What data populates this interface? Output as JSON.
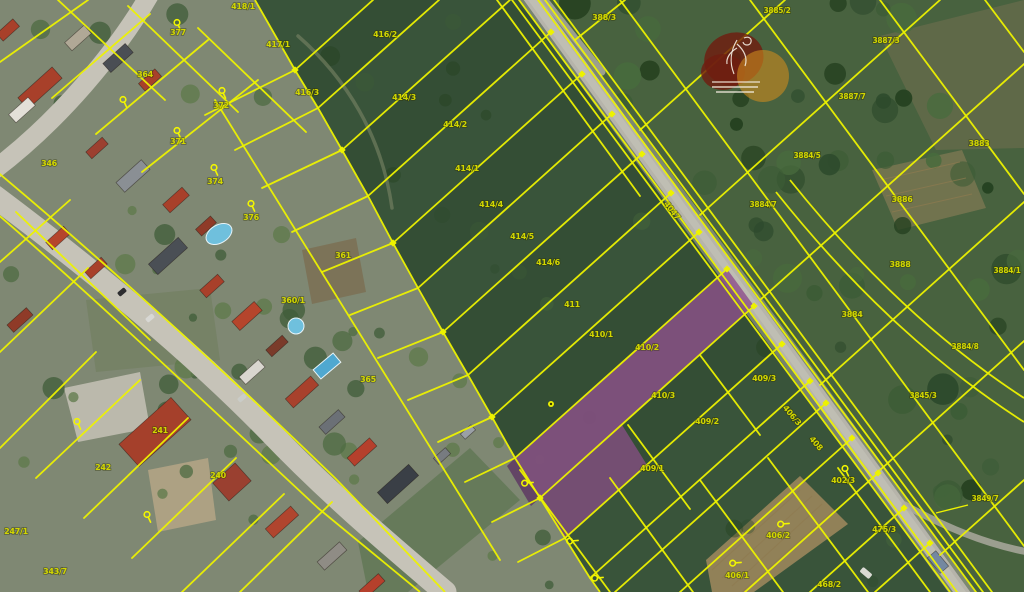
{
  "map": {
    "canvas": {
      "width": 1024,
      "height": 592
    },
    "colors": {
      "line_yellow": "#edf200",
      "label_yellow": "#d2d600",
      "selected_purple": "#8d4f8b",
      "selected_purple_dark": "#5e3a63",
      "field_green": "#39543a",
      "scrub_green": "#48623f",
      "village_base": "#7f8873",
      "road_gray": "#b6b4aa",
      "street_gray": "#c6c3b8",
      "watermark_maroon": "#6f1d10",
      "watermark_orange": "#cd8a1e"
    },
    "parcel_labels": [
      {
        "text": "418/1",
        "x": 243,
        "y": 9
      },
      {
        "text": "417/1",
        "x": 278,
        "y": 47
      },
      {
        "text": "416/2",
        "x": 385,
        "y": 37
      },
      {
        "text": "416/3",
        "x": 307,
        "y": 95
      },
      {
        "text": "414/3",
        "x": 404,
        "y": 100
      },
      {
        "text": "414/2",
        "x": 455,
        "y": 127
      },
      {
        "text": "414/1",
        "x": 467,
        "y": 171
      },
      {
        "text": "414/4",
        "x": 491,
        "y": 207
      },
      {
        "text": "414/5",
        "x": 522,
        "y": 239
      },
      {
        "text": "414/6",
        "x": 548,
        "y": 265
      },
      {
        "text": "411",
        "x": 572,
        "y": 307
      },
      {
        "text": "410/1",
        "x": 601,
        "y": 337
      },
      {
        "text": "410/2",
        "x": 647,
        "y": 350
      },
      {
        "text": "410/3",
        "x": 663,
        "y": 398
      },
      {
        "text": "409/3",
        "x": 764,
        "y": 381
      },
      {
        "text": "409/2",
        "x": 707,
        "y": 424
      },
      {
        "text": "409/1",
        "x": 652,
        "y": 471
      },
      {
        "text": "406/3",
        "x": 790,
        "y": 417,
        "rot": 50
      },
      {
        "text": "408",
        "x": 814,
        "y": 445,
        "rot": 50
      },
      {
        "text": "4047",
        "x": 670,
        "y": 212,
        "rot": 52
      },
      {
        "text": "388/3",
        "x": 604,
        "y": 20
      },
      {
        "text": "3885/2",
        "x": 777,
        "y": 13
      },
      {
        "text": "3887/3",
        "x": 886,
        "y": 43
      },
      {
        "text": "3887/7",
        "x": 852,
        "y": 99
      },
      {
        "text": "3883",
        "x": 979,
        "y": 146
      },
      {
        "text": "3884/5",
        "x": 807,
        "y": 158
      },
      {
        "text": "3884/7",
        "x": 763,
        "y": 207
      },
      {
        "text": "3886",
        "x": 902,
        "y": 202
      },
      {
        "text": "3888",
        "x": 900,
        "y": 267
      },
      {
        "text": "3884/1",
        "x": 1007,
        "y": 273
      },
      {
        "text": "3884",
        "x": 852,
        "y": 317
      },
      {
        "text": "3884/8",
        "x": 965,
        "y": 349
      },
      {
        "text": "3845/3",
        "x": 923,
        "y": 398
      },
      {
        "text": "3849/7",
        "x": 985,
        "y": 501
      },
      {
        "text": "402/3",
        "x": 843,
        "y": 483
      },
      {
        "text": "475/3",
        "x": 884,
        "y": 532
      },
      {
        "text": "468/2",
        "x": 829,
        "y": 587
      },
      {
        "text": "406/2",
        "x": 778,
        "y": 538
      },
      {
        "text": "406/1",
        "x": 737,
        "y": 578
      },
      {
        "text": "377",
        "x": 178,
        "y": 35
      },
      {
        "text": "372",
        "x": 221,
        "y": 108
      },
      {
        "text": "371",
        "x": 178,
        "y": 144
      },
      {
        "text": "374",
        "x": 215,
        "y": 184
      },
      {
        "text": "364",
        "x": 145,
        "y": 77
      },
      {
        "text": "346",
        "x": 49,
        "y": 166
      },
      {
        "text": "376",
        "x": 251,
        "y": 220
      },
      {
        "text": "361",
        "x": 343,
        "y": 258
      },
      {
        "text": "360/1",
        "x": 293,
        "y": 303
      },
      {
        "text": "365",
        "x": 368,
        "y": 382
      },
      {
        "text": "241",
        "x": 160,
        "y": 433
      },
      {
        "text": "240",
        "x": 218,
        "y": 478
      },
      {
        "text": "242",
        "x": 103,
        "y": 470
      },
      {
        "text": "247/1",
        "x": 16,
        "y": 534
      },
      {
        "text": "343/7",
        "x": 55,
        "y": 574
      }
    ],
    "pins": [
      {
        "x": 177,
        "y": 25,
        "rot": 0
      },
      {
        "x": 222,
        "y": 93,
        "rot": 0
      },
      {
        "x": 177,
        "y": 133,
        "rot": 0
      },
      {
        "x": 214,
        "y": 170,
        "rot": 0
      },
      {
        "x": 251,
        "y": 206,
        "rot": 0
      },
      {
        "x": 123,
        "y": 102,
        "rot": 0
      },
      {
        "x": 147,
        "y": 517,
        "rot": 0
      },
      {
        "x": 77,
        "y": 424,
        "rot": 0
      },
      {
        "x": 845,
        "y": 471,
        "rot": 0
      },
      {
        "x": 783,
        "y": 525,
        "rot": -70
      },
      {
        "x": 735,
        "y": 564,
        "rot": -70
      },
      {
        "x": 572,
        "y": 542,
        "rot": -70
      },
      {
        "x": 597,
        "y": 579,
        "rot": -70
      },
      {
        "x": 527,
        "y": 484,
        "rot": -70
      }
    ],
    "dots": [
      [
        551,
        404
      ]
    ],
    "nodes": [
      [
        551,
        32
      ],
      [
        582,
        74
      ],
      [
        612,
        114
      ],
      [
        642,
        154
      ],
      [
        671,
        193
      ],
      [
        699,
        232
      ],
      [
        727,
        269
      ],
      [
        754,
        306
      ],
      [
        782,
        344
      ],
      [
        810,
        381
      ],
      [
        826,
        403
      ],
      [
        852,
        438
      ],
      [
        878,
        473
      ],
      [
        904,
        508
      ],
      [
        930,
        543
      ],
      [
        295,
        70
      ],
      [
        342,
        150
      ],
      [
        393,
        243
      ],
      [
        443,
        332
      ],
      [
        492,
        417
      ],
      [
        540,
        498
      ]
    ],
    "leader_line": [
      968,
      505,
      936,
      513
    ],
    "selected_parcels": [
      {
        "id": "parcel-410-3",
        "points": "515,458 727,269 754,306 540,498",
        "fill": "#8d4f8b",
        "opacity": 0.8
      },
      {
        "id": "parcel-410-3-tip",
        "points": "515,458 540,498 531,506 507,466",
        "fill": "#5e3a63",
        "opacity": 0.85
      },
      {
        "id": "parcel-409-1-part",
        "points": "540,498 622,425 647,465 565,538",
        "fill": "#8d4f8b",
        "opacity": 0.72
      }
    ],
    "strip_lines": [
      [
        295,
        70,
        373,
        0
      ],
      [
        318,
        108,
        439,
        0
      ],
      [
        342,
        150,
        510,
        0
      ],
      [
        368,
        196,
        551,
        32
      ],
      [
        393,
        243,
        582,
        74
      ],
      [
        418,
        288,
        612,
        114
      ],
      [
        443,
        332,
        642,
        154
      ],
      [
        468,
        375,
        671,
        193
      ],
      [
        492,
        417,
        699,
        232
      ],
      [
        515,
        458,
        727,
        269
      ],
      [
        540,
        498,
        754,
        306
      ],
      [
        565,
        538,
        782,
        344
      ],
      [
        590,
        578,
        810,
        381
      ]
    ],
    "bottom_lines": [
      [
        615,
        592,
        826,
        403
      ],
      [
        680,
        592,
        852,
        438
      ],
      [
        745,
        592,
        878,
        473
      ],
      [
        810,
        592,
        904,
        508
      ],
      [
        875,
        592,
        930,
        543
      ],
      [
        520,
        470,
        610,
        592
      ],
      [
        610,
        478,
        693,
        592
      ],
      [
        700,
        480,
        783,
        592
      ],
      [
        768,
        458,
        868,
        592
      ],
      [
        838,
        468,
        930,
        592
      ],
      [
        628,
        425,
        690,
        509
      ],
      [
        700,
        355,
        760,
        435
      ]
    ],
    "right_lines": [
      [
        575,
        40,
        625,
        0
      ],
      [
        640,
        130,
        785,
        0
      ],
      [
        700,
        215,
        940,
        0
      ],
      [
        760,
        300,
        1024,
        64
      ],
      [
        820,
        385,
        1024,
        202
      ],
      [
        880,
        470,
        1024,
        341
      ],
      [
        940,
        555,
        1024,
        480
      ],
      [
        620,
        0,
        1024,
        546
      ],
      [
        750,
        0,
        1024,
        370
      ],
      [
        880,
        0,
        1024,
        194
      ],
      [
        985,
        0,
        1024,
        52
      ]
    ],
    "village_lines": [
      [
        0,
        62,
        88,
        0
      ],
      [
        52,
        98,
        150,
        14
      ],
      [
        96,
        134,
        208,
        40
      ],
      [
        142,
        172,
        258,
        80
      ],
      [
        58,
        0,
        165,
        100
      ],
      [
        128,
        6,
        238,
        112
      ],
      [
        198,
        28,
        306,
        132
      ],
      [
        0,
        262,
        70,
        200
      ],
      [
        0,
        352,
        88,
        268
      ],
      [
        0,
        448,
        96,
        352
      ],
      [
        36,
        478,
        140,
        380
      ],
      [
        84,
        518,
        188,
        418
      ],
      [
        132,
        558,
        236,
        458
      ],
      [
        182,
        592,
        284,
        494
      ],
      [
        240,
        592,
        332,
        502
      ],
      [
        16,
        212,
        150,
        340
      ],
      [
        205,
        115,
        295,
        70
      ],
      [
        235,
        150,
        318,
        108
      ],
      [
        262,
        188,
        342,
        150
      ],
      [
        292,
        232,
        368,
        196
      ],
      [
        322,
        272,
        393,
        243
      ],
      [
        350,
        315,
        418,
        288
      ],
      [
        378,
        358,
        443,
        332
      ],
      [
        408,
        400,
        468,
        375
      ],
      [
        438,
        442,
        492,
        417
      ],
      [
        465,
        482,
        515,
        458
      ],
      [
        492,
        522,
        540,
        498
      ],
      [
        518,
        562,
        565,
        538
      ],
      [
        215,
        100,
        500,
        560
      ]
    ],
    "road_corridor_lines": [
      [
        512,
        0,
        950,
        592
      ],
      [
        519,
        0,
        957,
        592
      ],
      [
        538,
        0,
        976,
        592
      ],
      [
        545,
        0,
        983,
        592
      ],
      [
        554,
        0,
        992,
        592
      ],
      [
        497,
        0,
        640,
        196
      ]
    ],
    "line_paths": [
      "M 255,0 L 295,70 318,108 342,150 368,196 393,243 418,288 443,332 468,375 492,417 515,458 540,498 565,538 590,578 600,592",
      "M 790,180 C 870,280 950,350 1024,398",
      "M 776,192 C 858,295 940,368 1024,422",
      "M -5,170 C 100,258 215,362 335,478 L 445,592",
      "M -5,212 C 88,292 200,398 318,508 L 420,592"
    ],
    "roads": [
      {
        "d": "M 528,-6 L 966,598",
        "w": 22,
        "c": "#a9a79d",
        "o": 0.55
      },
      {
        "d": "M 528,-6 L 966,598",
        "w": 14,
        "c": "#b6b4aa",
        "o": 1
      },
      {
        "d": "M 528,-6 L 966,598",
        "w": 7,
        "c": "#c5c3b9",
        "o": 0.65
      },
      {
        "d": "M 540,-6 L 602,72",
        "w": 7,
        "c": "#b0aea4",
        "o": 0.8
      },
      {
        "d": "M 150,-6 C 118,50 60,120 -6,170",
        "w": 19,
        "c": "#c6c3b8",
        "o": 1
      },
      {
        "d": "M -6,196 C 90,268 190,350 268,430 C 330,495 390,545 445,592",
        "w": 23,
        "c": "#c6c3b8",
        "o": 1
      },
      {
        "d": "M 905,505 C 950,530 990,545 1028,552",
        "w": 7,
        "c": "#b0aea4",
        "o": 0.8
      },
      {
        "d": "M 298,36 C 346,78 382,136 392,208",
        "w": 3.5,
        "c": "#707e60",
        "o": 0.7
      }
    ],
    "patches": [
      {
        "pts": "0,0 255,0 295,70 342,150 393,243 443,332 492,417 540,498 590,578 600,592 0,592",
        "fill": "#7f8873",
        "op": 1
      },
      {
        "pts": "528,0 1024,0 1024,592 966,592",
        "fill": "#48623f",
        "op": 1
      },
      {
        "pts": "880,36 1024,0 1024,148 936,150",
        "fill": "#7d7455",
        "op": 0.45
      },
      {
        "pts": "872,170 962,150 986,208 898,230",
        "fill": "#8d7f58",
        "op": 0.6
      },
      {
        "pts": "706,560 800,476 848,524 754,592 712,592",
        "fill": "#a18a5e",
        "op": 0.85
      },
      {
        "pts": "64,388 140,372 150,428 78,442",
        "fill": "#c2bfb2",
        "op": 0.9
      },
      {
        "pts": "148,470 208,458 216,520 158,532",
        "fill": "#b9a887",
        "op": 0.8
      },
      {
        "pts": "302,250 356,238 366,292 312,304",
        "fill": "#7a6b4d",
        "op": 0.7
      },
      {
        "pts": "86,300 210,288 220,360 96,372",
        "fill": "#6d7c59",
        "op": 0.5
      },
      {
        "pts": "358,542 470,448 520,500 408,592 368,592",
        "fill": "#55714a",
        "op": 0.6
      }
    ],
    "row_lines": [
      [
        712,
        570,
        800,
        490
      ],
      [
        722,
        578,
        812,
        496
      ],
      [
        732,
        586,
        822,
        504
      ],
      [
        742,
        592,
        832,
        512
      ],
      [
        880,
        180,
        960,
        162
      ],
      [
        886,
        196,
        966,
        178
      ],
      [
        892,
        212,
        972,
        194
      ]
    ],
    "buildings": [
      [
        40,
        88,
        46,
        15,
        -42,
        "#a8402a"
      ],
      [
        22,
        110,
        26,
        11,
        -42,
        "#e3e0d8"
      ],
      [
        78,
        38,
        26,
        11,
        -42,
        "#b0a896"
      ],
      [
        118,
        58,
        30,
        12,
        -42,
        "#4a4e54"
      ],
      [
        150,
        80,
        22,
        10,
        -42,
        "#a8402a"
      ],
      [
        97,
        148,
        22,
        9,
        -42,
        "#9c4030"
      ],
      [
        133,
        176,
        34,
        13,
        -42,
        "#8a8f94"
      ],
      [
        176,
        200,
        26,
        11,
        -42,
        "#a8402a"
      ],
      [
        206,
        226,
        20,
        9,
        -42,
        "#8f3b28"
      ],
      [
        168,
        256,
        40,
        14,
        -42,
        "#4a4f55"
      ],
      [
        212,
        286,
        24,
        10,
        -42,
        "#a8402a"
      ],
      [
        247,
        316,
        30,
        12,
        -42,
        "#b5452c"
      ],
      [
        277,
        346,
        22,
        9,
        -42,
        "#7a3b2a"
      ],
      [
        252,
        372,
        26,
        10,
        -42,
        "#d9d6cf"
      ],
      [
        302,
        392,
        34,
        12,
        -42,
        "#a8412c"
      ],
      [
        332,
        422,
        26,
        10,
        -42,
        "#6b7076"
      ],
      [
        362,
        452,
        30,
        11,
        -42,
        "#b5402c"
      ],
      [
        398,
        484,
        42,
        15,
        -42,
        "#3a3f46"
      ],
      [
        155,
        432,
        70,
        30,
        -42,
        "#a5402b"
      ],
      [
        232,
        482,
        30,
        24,
        -42,
        "#9a4030"
      ],
      [
        282,
        522,
        34,
        12,
        -42,
        "#b0452e"
      ],
      [
        332,
        556,
        30,
        11,
        -42,
        "#8f8c85"
      ],
      [
        372,
        586,
        26,
        10,
        -42,
        "#b5402c"
      ],
      [
        8,
        30,
        22,
        10,
        -42,
        "#a8402a"
      ],
      [
        442,
        456,
        16,
        8,
        -42,
        "#777b80"
      ],
      [
        468,
        432,
        14,
        7,
        -42,
        "#9aa0a6"
      ],
      [
        938,
        562,
        20,
        11,
        50,
        "#7488a0"
      ],
      [
        58,
        238,
        24,
        10,
        -42,
        "#b5452c"
      ],
      [
        96,
        268,
        22,
        9,
        -42,
        "#a8402a"
      ],
      [
        20,
        320,
        26,
        10,
        -42,
        "#8f3b28"
      ]
    ],
    "cars": [
      [
        122,
        292,
        9,
        5,
        -40,
        "#2d2d30"
      ],
      [
        150,
        318,
        9,
        5,
        -40,
        "#d8d8d4"
      ],
      [
        242,
        398,
        9,
        5,
        -40,
        "#caccc8"
      ],
      [
        866,
        573,
        12,
        6,
        40,
        "#dadad4"
      ]
    ],
    "pools": [
      {
        "type": "ellipse",
        "x": 219,
        "y": 234,
        "rx": 14,
        "ry": 9,
        "rot": -30
      },
      {
        "type": "circle",
        "x": 296,
        "y": 326,
        "r": 8
      },
      {
        "type": "rect",
        "x": 327,
        "y": 366,
        "w": 26,
        "h": 12,
        "rot": -40
      }
    ],
    "watermark": {
      "x": 737,
      "y": 62,
      "tree_paths": [
        "M 737,40 C 731,50 729,62 734,74",
        "M 737,44 C 744,50 748,58 745,66",
        "M 737,48 C 730,52 726,58 727,64",
        "M 744,38 c 4,-2 8,0 7,4 c -1,4 -7,4 -8,0",
        "M 712,82 L 760,82"
      ],
      "text_bars": [
        [
          712,
          87,
          46
        ],
        [
          716,
          92,
          38
        ]
      ]
    }
  }
}
